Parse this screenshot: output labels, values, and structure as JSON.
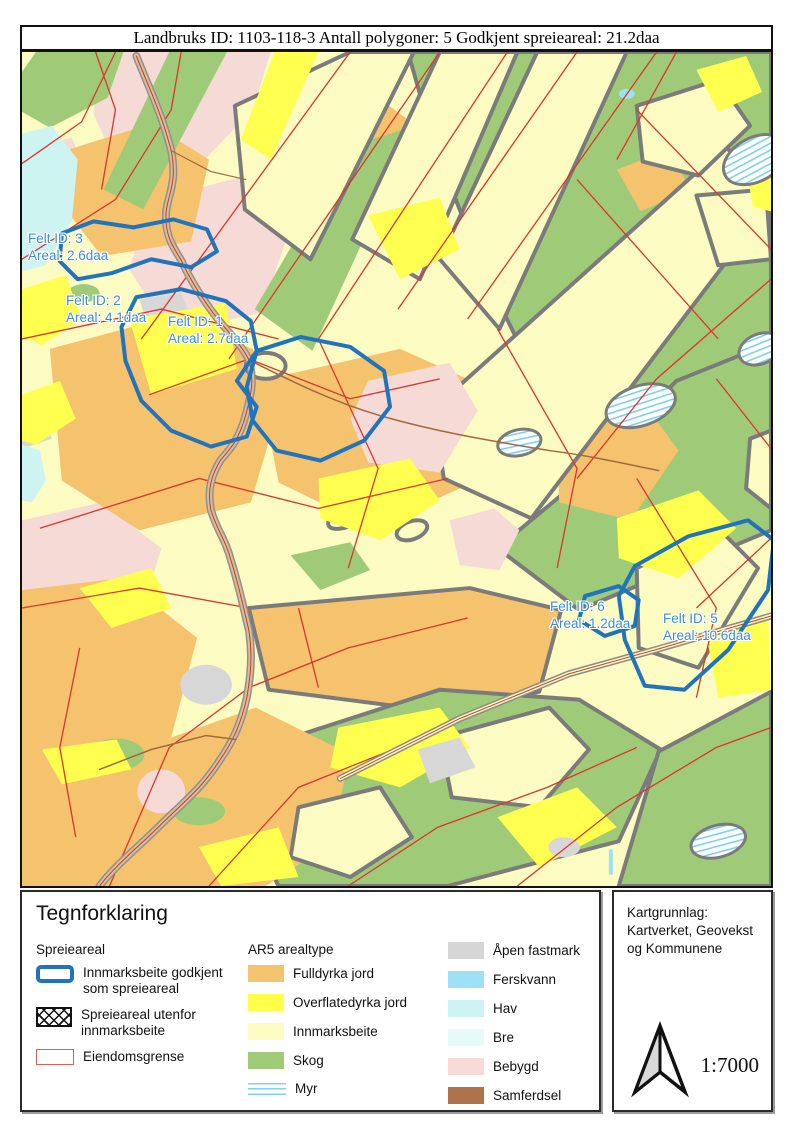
{
  "title_bar": {
    "text": "Landbruks ID: 1103-118-3 Antall polygoner: 5 Godkjent spreieareal: 21.2daa"
  },
  "map": {
    "field_labels": [
      {
        "felt": "Felt ID: 1",
        "areal": "Areal: 2.7daa"
      },
      {
        "felt": "Felt ID: 2",
        "areal": "Areal: 4.1daa"
      },
      {
        "felt": "Felt ID: 3",
        "areal": "Areal: 2.6daa"
      },
      {
        "felt": "Felt ID: 5",
        "areal": "Areal: 10.6daa"
      },
      {
        "felt": "Felt ID: 6",
        "areal": "Areal: 1.2daa"
      }
    ]
  },
  "legend": {
    "title": "Tegnforklaring",
    "spreieareal_heading": "Spreieareal",
    "spreieareal_items": [
      {
        "label": "Innmarksbeite godkjent som spreieareal",
        "swatch": "blue-outline",
        "color": "#2273BD"
      },
      {
        "label": "Spreieareal utenfor innmarksbeite",
        "swatch": "black-crosshatch",
        "color": "#111111"
      },
      {
        "label": "Eiendomsgrense",
        "swatch": "red-outline",
        "color": "#E25C55"
      }
    ],
    "ar5_heading": "AR5 arealtype",
    "ar5_items": [
      {
        "label": "Fulldyrka jord",
        "color": "#F5C26E"
      },
      {
        "label": "Overflatedyrka jord",
        "color": "#FFFF4A"
      },
      {
        "label": "Innmarksbeite",
        "color": "#FCFCC0"
      },
      {
        "label": "Skog",
        "color": "#9FCB78"
      },
      {
        "label": "Myr",
        "color": "#7DD2F2"
      },
      {
        "label": "Åpen fastmark",
        "color": "#D6D6D6"
      },
      {
        "label": "Ferskvann",
        "color": "#9EE0F5"
      },
      {
        "label": "Hav",
        "color": "#CDF3F3"
      },
      {
        "label": "Bre",
        "color": "#E6FAFA"
      },
      {
        "label": "Bebygd",
        "color": "#F7DBD8"
      },
      {
        "label": "Samferdsel",
        "color": "#AE734A"
      }
    ]
  },
  "info_box": {
    "source_line1": "Kartgrunnlag:",
    "source_line2": "Kartverket, Geovekst",
    "source_line3": "og Kommunene",
    "scale": "1:7000"
  },
  "colors": {
    "felt_outline_blue": "#2173BC",
    "felt_label_blue": "#3E8FD2",
    "property_line_red": "#DC352B",
    "area_outline_gray": "#7B7B7B",
    "road_fill_tan": "#D9BF97"
  }
}
